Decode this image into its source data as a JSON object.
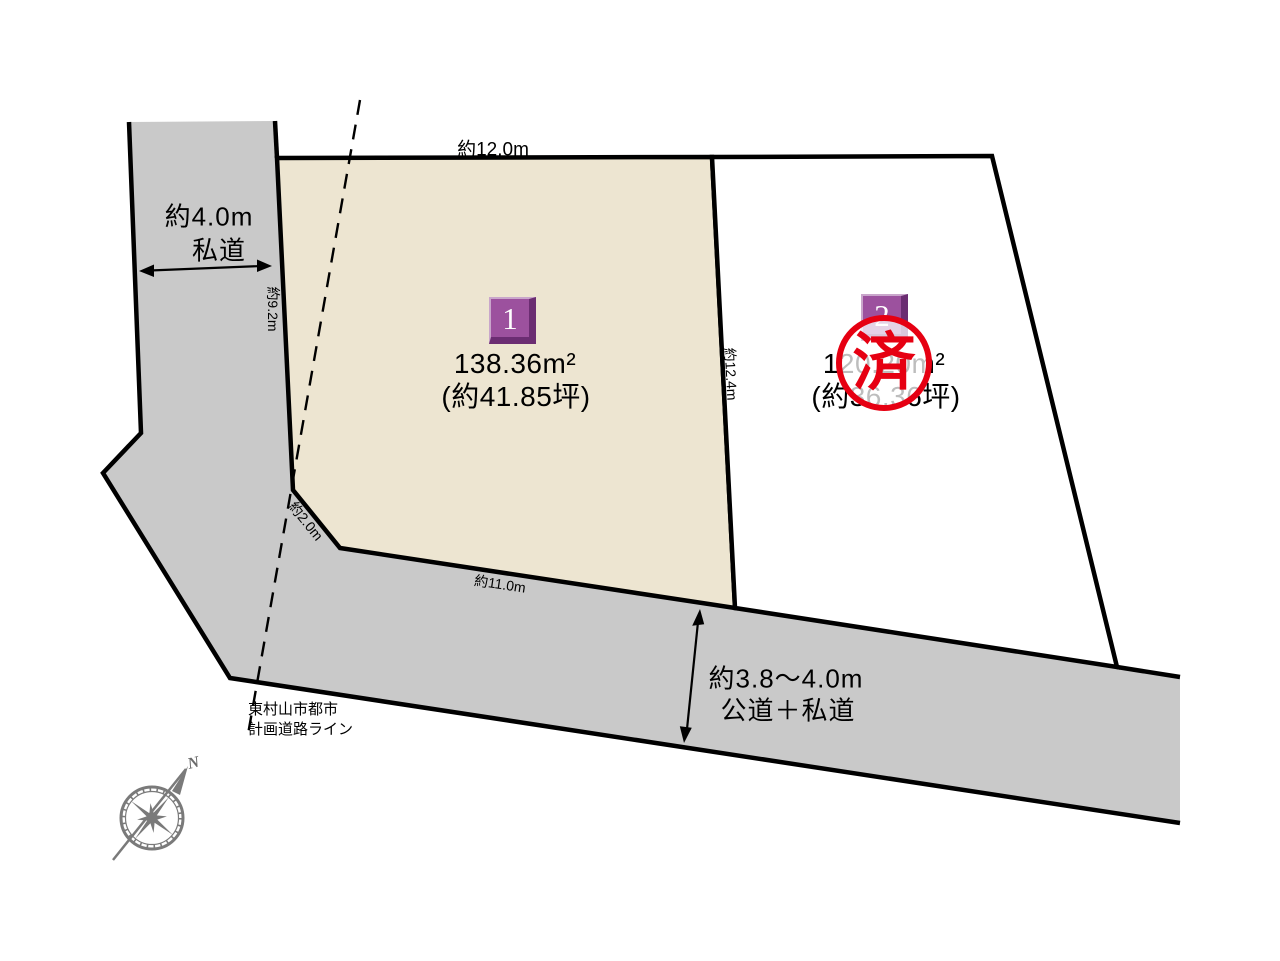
{
  "diagram": {
    "roads": {
      "left": {
        "width": "約4.0m",
        "type": "私道"
      },
      "bottom": {
        "width": "約3.8〜4.0m",
        "type": "公道＋私道"
      }
    },
    "plots": {
      "plot1": {
        "number": "1",
        "area_m2": "138.36m²",
        "area_tsubo": "(約41.85坪)"
      },
      "plot2": {
        "number": "2",
        "area_m2": "120.20m²",
        "area_tsubo": "(約36.36坪)",
        "stamp": "済"
      }
    },
    "dimensions": {
      "plot1_top": "約12.0m",
      "plot1_left": "約9.2m",
      "plot1_corner": "約2.0m",
      "plot1_bottom": "約11.0m",
      "divider": "約12.4m"
    },
    "planning_line": {
      "line1": "東村山市都市",
      "line2": "計画道路ライン"
    },
    "compass": {
      "north": "N"
    },
    "colors": {
      "plot1_fill": "#EDE5D1",
      "plot2_fill": "#FFFFFF",
      "road_fill": "#C9C9C9",
      "line_black": "#000000",
      "chip_purple": "#9C519E",
      "chip_purple_dark": "#6B2D72",
      "stamp_red": "#E60012",
      "compass_gray": "#7A7A7A"
    }
  }
}
